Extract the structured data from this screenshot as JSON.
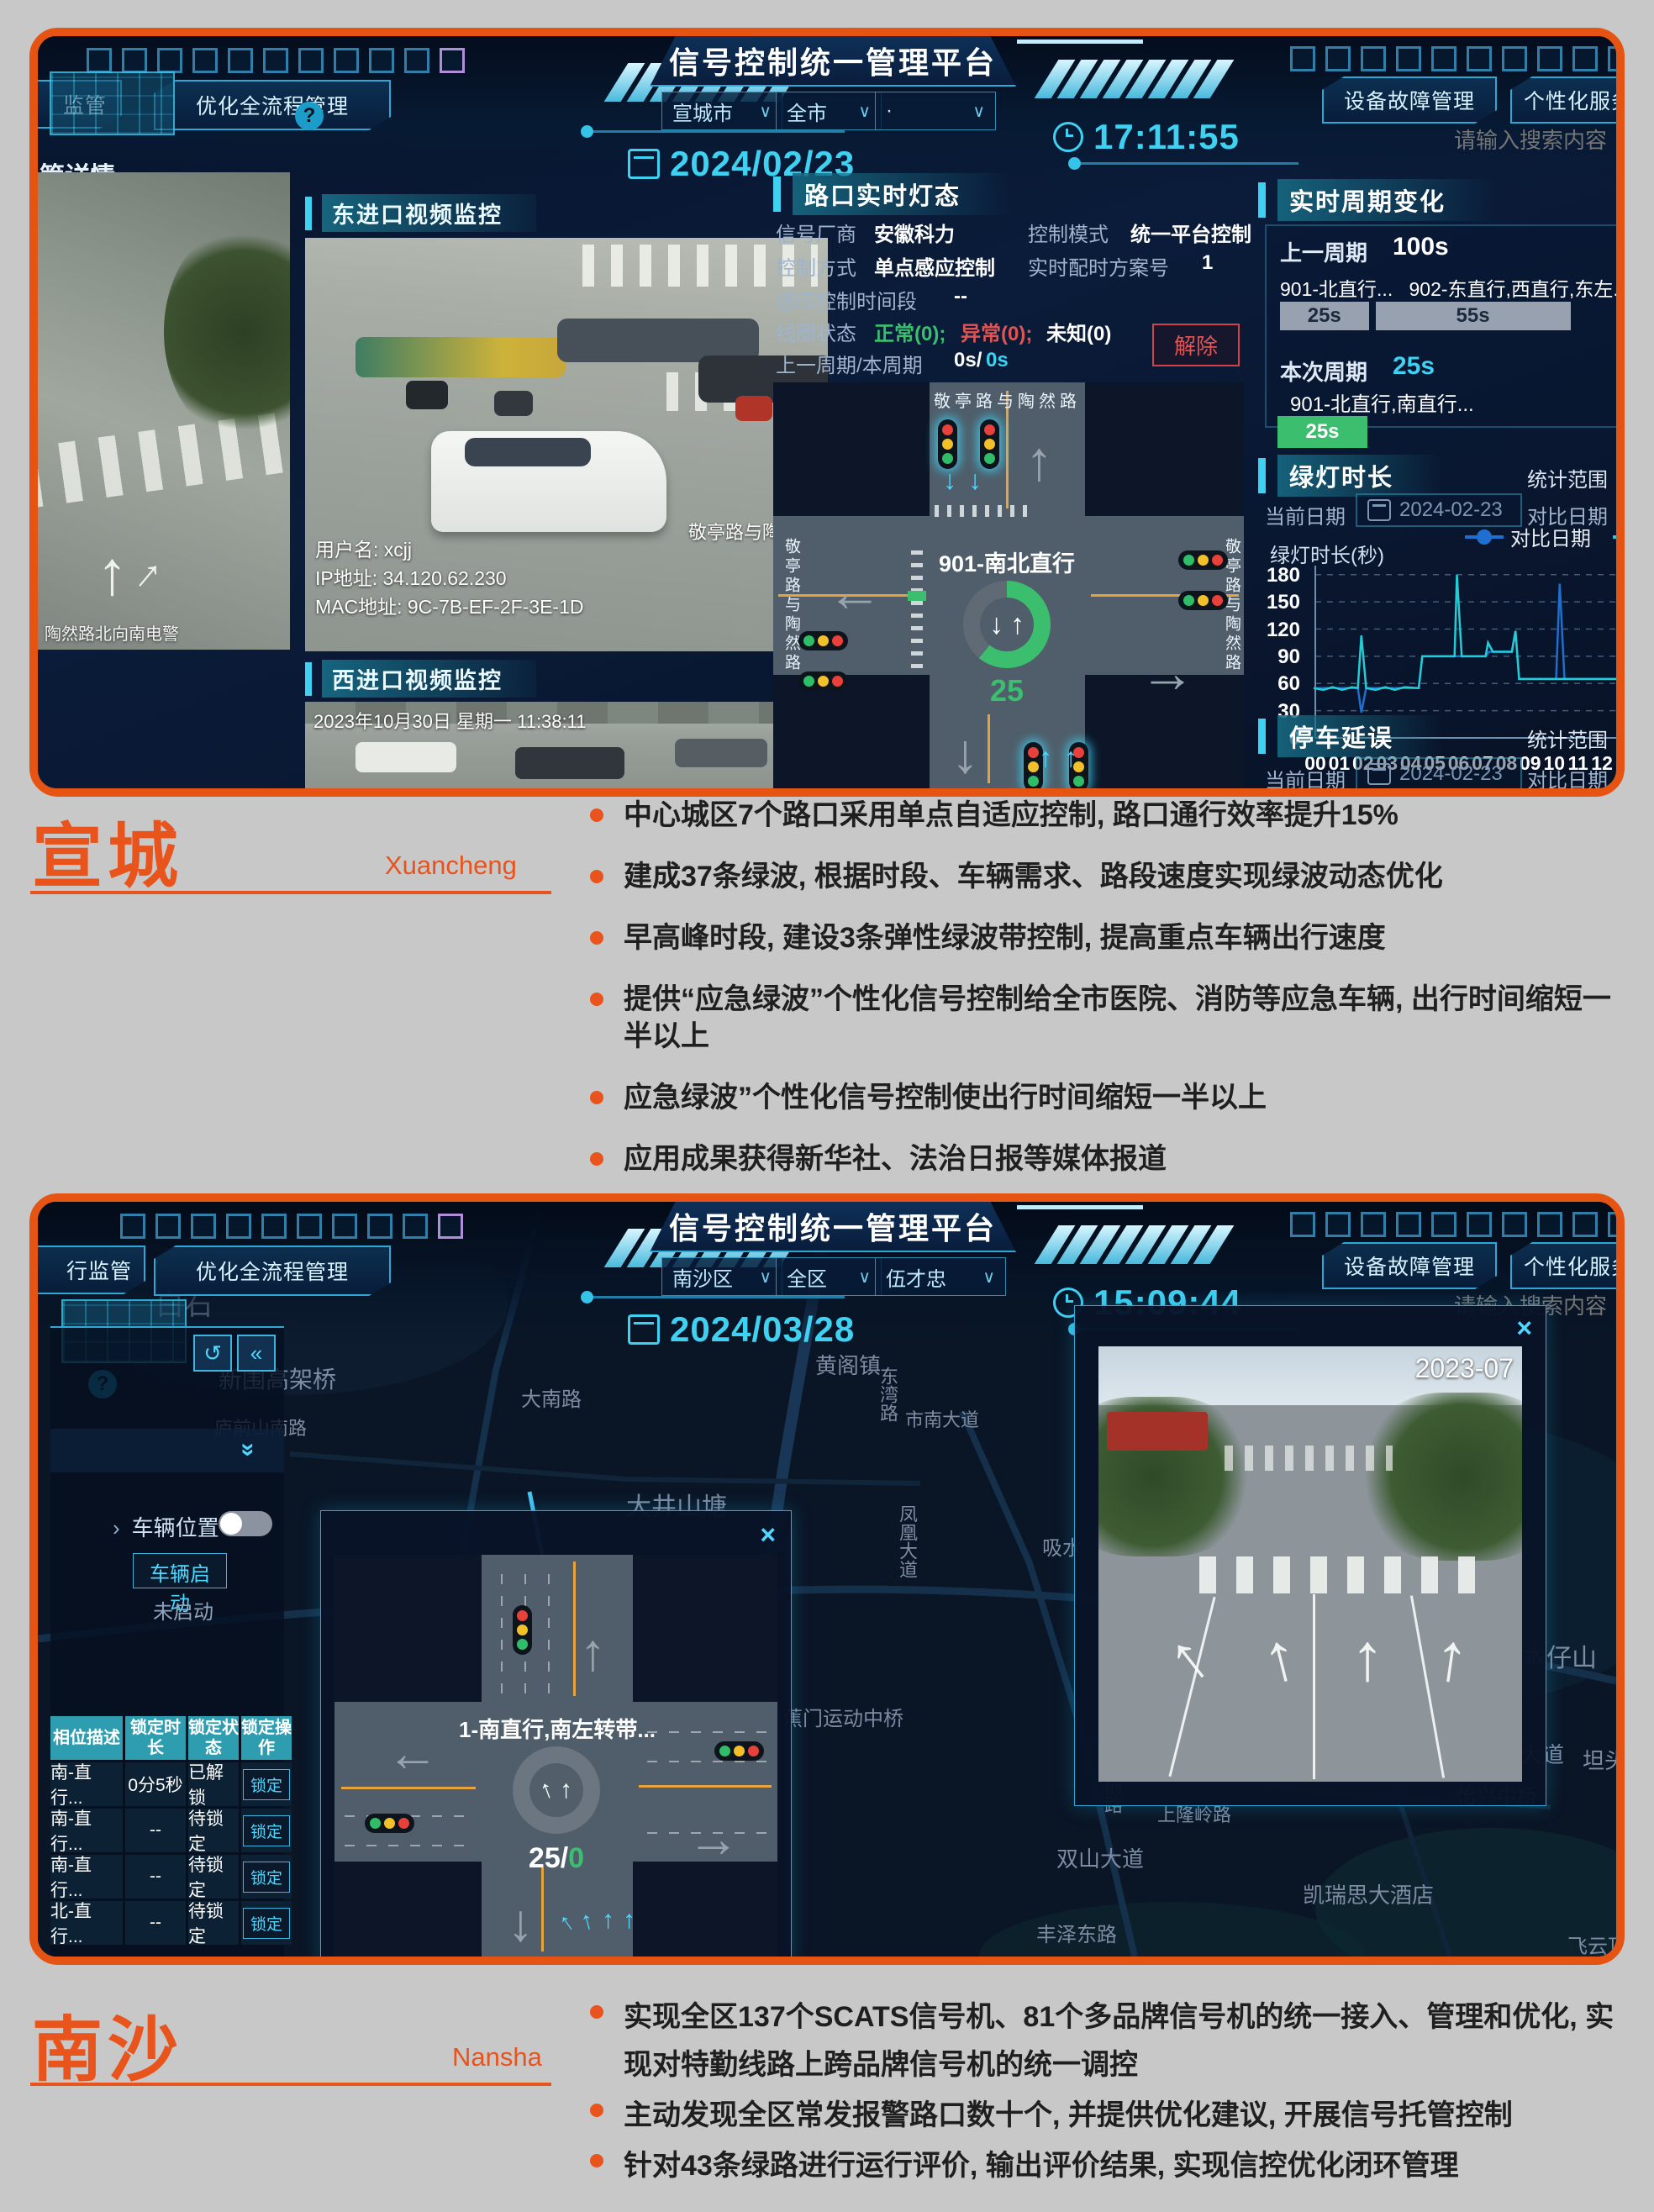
{
  "platform_title": "信号控制统一管理平台",
  "dash1": {
    "nav_left_partial": "监管",
    "nav_left2": "优化全流程管理",
    "date": "2024/02/23",
    "time": "17:11:55",
    "region_select": "宣城市",
    "scope_select": "全市",
    "third_select": "·",
    "nav_right1": "设备故障管理",
    "nav_right2": "个性化服务管理",
    "search_placeholder": "请输入搜索内容",
    "breadcrumb": "管详情",
    "video_east_label": "东进口视频监控",
    "video_west_label": "西进口视频监控",
    "video_overlay": {
      "user": "用户名: xcjj",
      "ip": "IP地址: 34.120.62.230",
      "mac": "MAC地址: 9C-7B-EF-2F-3E-1D",
      "watermark1": "安徽",
      "watermark2": "宣城",
      "watermark3": "宣州",
      "watermark4": "敬亭路与陶然路",
      "left_watermark": "陶然路北向南电警",
      "timestamp": "2023年10月30日 星期一  11:38:11"
    },
    "light_panel": {
      "title": "路口实时灯态",
      "vendor_label": "信号厂商",
      "vendor": "安徽科力",
      "mode_label": "控制模式",
      "mode": "统一平台控制",
      "ctrl_label": "控制方式",
      "ctrl": "单点感应控制",
      "plan_label": "实时配时方案号",
      "plan": "1",
      "induct_label": "感应控制时间段",
      "induct": "--",
      "coil_label": "线圈状态",
      "coil_normal": "正常(0);",
      "coil_abnormal": "异常(0);",
      "coil_unknown": "未知(0)",
      "cycle_label": "上一周期/本周期",
      "cycle_white": "0s/",
      "cycle_cyan": "0s",
      "release_btn": "解除",
      "junction": {
        "road": "敬亭路与陶然路",
        "phase": "901-南北直行",
        "count": "25"
      }
    },
    "cycle_panel": {
      "title": "实时周期变化",
      "prev_label": "上一周期",
      "prev_value": "100s",
      "total_seconds": 100,
      "bars": [
        {
          "name": "901-北直行...",
          "secs": 25,
          "dur": "25s"
        },
        {
          "name": "902-东直行,西直行,东左...",
          "secs": 55,
          "dur": "55s"
        }
      ],
      "cur_label": "本次周期",
      "cur_value": "25s",
      "cur_phase": "901-北直行,南直行...",
      "cur_bar": "25s"
    },
    "green_panel": {
      "title": "绿灯时长",
      "range_label": "统计范围",
      "cur_date_label": "当前日期",
      "cur_date": "2024-02-23",
      "cmp_date_label": "对比日期",
      "cmp_date": "2023-",
      "y_label": "绿灯时长(秒)"
    },
    "delay_panel": {
      "title": "停车延误",
      "range_label": "统计范围",
      "cur_date_label": "当前日期",
      "cur_date": "2024-02-23",
      "cmp_date_label": "对比日期",
      "cmp_date": "2023-"
    }
  },
  "chart_data": {
    "type": "line",
    "title": "绿灯时长",
    "ylabel": "绿灯时长(秒)",
    "ylim": [
      0,
      190
    ],
    "xlim": [
      0,
      14.6
    ],
    "x_ticks": [
      "00",
      "01",
      "02",
      "03",
      "04",
      "05",
      "06",
      "07",
      "08",
      "09",
      "10",
      "11",
      "12",
      "13",
      "14"
    ],
    "y_ticks": [
      0,
      30,
      60,
      90,
      120,
      150,
      180
    ],
    "grid": true,
    "legend_position": "top-right",
    "series": [
      {
        "name": "对比日期",
        "color": "#1f6fd0",
        "points": [
          [
            0,
            55
          ],
          [
            1.85,
            55
          ],
          [
            2,
            28
          ],
          [
            2.2,
            55
          ],
          [
            4.4,
            55
          ],
          [
            4.55,
            90
          ],
          [
            7.2,
            90
          ],
          [
            7.35,
            95
          ],
          [
            8.3,
            95
          ],
          [
            8.45,
            118
          ],
          [
            8.6,
            65
          ],
          [
            10.15,
            65
          ],
          [
            10.3,
            170
          ],
          [
            10.5,
            65
          ],
          [
            14.6,
            65
          ]
        ]
      },
      {
        "name": "当前日期",
        "color": "#22cdd6",
        "points": [
          [
            0,
            55
          ],
          [
            0.4,
            53
          ],
          [
            0.8,
            56
          ],
          [
            1.2,
            53
          ],
          [
            1.6,
            56
          ],
          [
            1.85,
            55
          ],
          [
            2,
            113
          ],
          [
            2.2,
            55
          ],
          [
            2.6,
            53
          ],
          [
            3,
            56
          ],
          [
            3.4,
            53
          ],
          [
            3.8,
            56
          ],
          [
            4.4,
            55
          ],
          [
            4.55,
            90
          ],
          [
            5.9,
            90
          ],
          [
            6,
            180
          ],
          [
            6.2,
            90
          ],
          [
            7.2,
            90
          ],
          [
            7.3,
            105
          ],
          [
            7.5,
            95
          ],
          [
            8.3,
            95
          ],
          [
            8.45,
            118
          ],
          [
            8.6,
            65
          ],
          [
            14.6,
            65
          ]
        ]
      }
    ]
  },
  "xuancheng": {
    "name": "宣城",
    "latin": "Xuancheng",
    "bullets": [
      "中心城区7个路口采用单点自适应控制, 路口通行效率提升15%",
      "建成37条绿波, 根据时段、车辆需求、路段速度实现绿波动态优化",
      "早高峰时段, 建设3条弹性绿波带控制, 提高重点车辆出行速度",
      "提供“应急绿波”个性化信号控制给全市医院、消防等应急车辆, 出行时间缩短一半以上",
      "应急绿波”个性化信号控制使出行时间缩短一半以上",
      "应用成果获得新华社、法治日报等媒体报道"
    ]
  },
  "dash2": {
    "nav_left_partial": "行监管",
    "nav_left2": "优化全流程管理",
    "date": "2024/03/28",
    "time": "15:09:44",
    "region_select": "南沙区",
    "scope_select": "全区",
    "user_select": "伍才忠",
    "nav_right1": "设备故障管理",
    "nav_right2": "个性化服务管理",
    "search_placeholder": "请输入搜索内容",
    "map_labels": [
      {
        "t": "白石",
        "x": 140,
        "y": 95,
        "s": 34
      },
      {
        "t": "新围高架桥",
        "x": 215,
        "y": 190,
        "s": 28
      },
      {
        "t": "黄阁镇",
        "x": 925,
        "y": 175,
        "s": 26
      },
      {
        "t": "大南路",
        "x": 575,
        "y": 215,
        "s": 24
      },
      {
        "t": "庐前山南路",
        "x": 210,
        "y": 252,
        "s": 22
      },
      {
        "t": "东湾路",
        "x": 995,
        "y": 196,
        "s": 22,
        "v": 1
      },
      {
        "t": "市南大道",
        "x": 1032,
        "y": 242,
        "s": 22
      },
      {
        "t": "大井山塘",
        "x": 700,
        "y": 338,
        "s": 30
      },
      {
        "t": "凤凰大道",
        "x": 1018,
        "y": 360,
        "s": 22,
        "v": 1
      },
      {
        "t": "吸水",
        "x": 1195,
        "y": 392,
        "s": 24
      },
      {
        "t": "日本仔山",
        "x": 1735,
        "y": 518,
        "s": 30
      },
      {
        "t": "蕉门运动中桥",
        "x": 886,
        "y": 595,
        "s": 24
      },
      {
        "t": "进港大道",
        "x": 1712,
        "y": 638,
        "s": 26
      },
      {
        "t": "坦头",
        "x": 1838,
        "y": 645,
        "s": 26
      },
      {
        "t": "府前路",
        "x": 1262,
        "y": 662,
        "s": 22,
        "v": 1
      },
      {
        "t": "怡兴中桥",
        "x": 1688,
        "y": 688,
        "s": 24
      },
      {
        "t": "上隆岭路",
        "x": 1332,
        "y": 712,
        "s": 22
      },
      {
        "t": "双山大道",
        "x": 1212,
        "y": 762,
        "s": 26
      },
      {
        "t": "凯瑞思大酒店",
        "x": 1505,
        "y": 805,
        "s": 26
      },
      {
        "t": "丰泽东路",
        "x": 1188,
        "y": 852,
        "s": 24
      },
      {
        "t": "飞云顶",
        "x": 1820,
        "y": 866,
        "s": 24
      }
    ],
    "sidebar": {
      "vehicle_toggle_label": "车辆位置",
      "start_btn": "车辆启动",
      "status": "未启动",
      "back_icon": "↺",
      "collapse_icon": "«",
      "expand_icon": "»",
      "table": {
        "headers": [
          "相位描述",
          "锁定时长",
          "锁定状态",
          "锁定操作"
        ],
        "rows": [
          [
            "南-直行...",
            "0分5秒",
            "已解锁",
            "锁定"
          ],
          [
            "南-直行...",
            "--",
            "待锁定",
            "锁定"
          ],
          [
            "南-直行...",
            "--",
            "待锁定",
            "锁定"
          ],
          [
            "北-直行...",
            "--",
            "待锁定",
            "锁定"
          ]
        ]
      }
    },
    "junction_popup": {
      "phase": "1-南直行,南左转带...",
      "count_white": "25/",
      "count_green": "0"
    },
    "video_popup": {
      "timestamp": "2023-07"
    }
  },
  "nansha": {
    "name": "南沙",
    "latin": "Nansha",
    "bullets": [
      "实现全区137个SCATS信号机、81个多品牌信号机的统一接入、管理和优化, 实现对特勤线路上跨品牌信号机的统一调控",
      "主动发现全区常发报警路口数十个, 并提供优化建议, 开展信号托管控制",
      "针对43条绿路进行运行评价, 输出评价结果, 实现信控优化闭环管理"
    ]
  }
}
